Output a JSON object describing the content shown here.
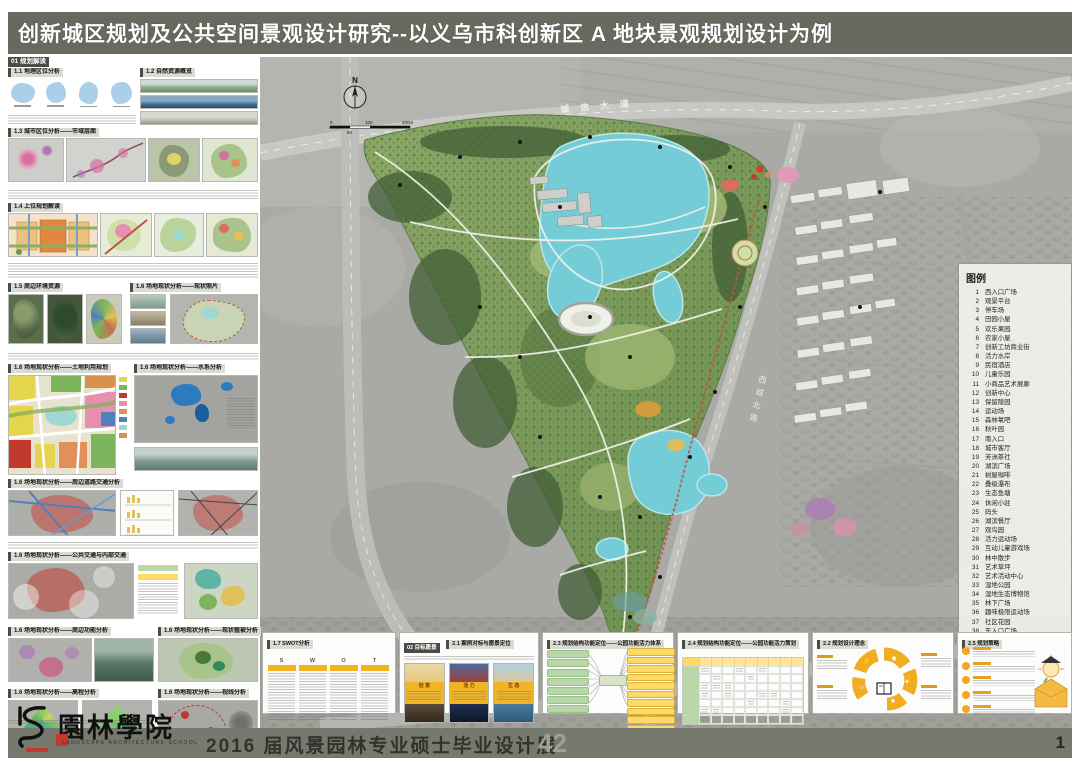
{
  "title": "创新城区规划及公共空间景观设计研究--以义乌市科创新区 A 地块景观规划设计为例",
  "page_no": "1",
  "footer": {
    "logo_cn": "園林學院",
    "logo_en": "LANDSCAPE ARCHITECTURE SCHOOL",
    "exhibition": "2016 届风景园林专业硕士毕业设计展",
    "board_no": "42"
  },
  "map": {
    "road_top": "诚信大道",
    "road_right": "西城北路",
    "north": "N",
    "scale": {
      "t0": "0",
      "t1": "50",
      "t2": "100",
      "t3": "200m"
    }
  },
  "legend": {
    "title": "图例",
    "items": [
      {
        "n": "1",
        "t": "西入口广场"
      },
      {
        "n": "2",
        "t": "观景平台"
      },
      {
        "n": "3",
        "t": "停车场"
      },
      {
        "n": "4",
        "t": "田园小屋"
      },
      {
        "n": "5",
        "t": "欢乐果园"
      },
      {
        "n": "6",
        "t": "农家小屋"
      },
      {
        "n": "7",
        "t": "创新工坊商业街"
      },
      {
        "n": "8",
        "t": "活力水岸"
      },
      {
        "n": "9",
        "t": "民宿酒店"
      },
      {
        "n": "10",
        "t": "儿童乐园"
      },
      {
        "n": "11",
        "t": "小商品艺术展廊"
      },
      {
        "n": "12",
        "t": "创新中心"
      },
      {
        "n": "13",
        "t": "保留陵园"
      },
      {
        "n": "14",
        "t": "运动场"
      },
      {
        "n": "15",
        "t": "森林氧吧"
      },
      {
        "n": "16",
        "t": "秋叶园"
      },
      {
        "n": "17",
        "t": "南入口"
      },
      {
        "n": "18",
        "t": "城市客厅"
      },
      {
        "n": "19",
        "t": "芳洲茶社"
      },
      {
        "n": "20",
        "t": "湖滨广场"
      },
      {
        "n": "21",
        "t": "树屋咖啡"
      },
      {
        "n": "22",
        "t": "叠级瀑布"
      },
      {
        "n": "23",
        "t": "生态鱼塘"
      },
      {
        "n": "24",
        "t": "休闲小驻"
      },
      {
        "n": "25",
        "t": "码头"
      },
      {
        "n": "26",
        "t": "湖滨餐厅"
      },
      {
        "n": "27",
        "t": "观鸟园"
      },
      {
        "n": "28",
        "t": "活力运动场"
      },
      {
        "n": "29",
        "t": "互动儿童游戏场"
      },
      {
        "n": "30",
        "t": "林中散步"
      },
      {
        "n": "31",
        "t": "艺术草坪"
      },
      {
        "n": "32",
        "t": "艺术活动中心"
      },
      {
        "n": "33",
        "t": "湿地公园"
      },
      {
        "n": "34",
        "t": "湿地生态博物馆"
      },
      {
        "n": "35",
        "t": "林下广场"
      },
      {
        "n": "36",
        "t": "趣味极限运动场"
      },
      {
        "n": "37",
        "t": "社区花园"
      },
      {
        "n": "38",
        "t": "东入口广场"
      },
      {
        "n": "39",
        "t": "创新街区"
      }
    ]
  },
  "left": {
    "s01": "01 规划解读",
    "h11": "1.1 地理区位分析",
    "h12": "1.2 自然资源概览",
    "h13": "1.3 城市区位分析——市域层面",
    "h14": "1.4 上位规划解读",
    "h15": "1.5 周边环境资源",
    "h16a": "1.6 场地现状分析——现状照片",
    "h16b": "1.6 场地现状分析——土地利用规划",
    "h16c": "1.6 场地现状分析——水系分析",
    "h16d": "1.6 场地现状分析——周边道路交通分析",
    "h16e": "1.6 场地现状分析——公共交通与内部交通",
    "h16f": "1.6 场地现状分析——周边功能分析",
    "h16f2": "1.6 场地现状分析——现状植被分析",
    "h16g": "1.6 场地现状分析——高程分析",
    "h16h": "1.6 场地现状分析——视线分析"
  },
  "bottom": {
    "swot": {
      "title": "1.7 SWOT分析",
      "letters": [
        "S",
        "W",
        "O",
        "T"
      ]
    },
    "vision": {
      "chip": "02 目标愿景",
      "title": "2.1 案例对标与愿景定位",
      "cards": [
        "创 意",
        "活 力",
        "生 态"
      ]
    },
    "p23": {
      "title": "2.3 规划结构功能定位——公园功能活力体系"
    },
    "p24": {
      "title": "2.4 规划结构功能定位——公园功能活力策划"
    },
    "p22": {
      "title": "2.2 规划设计理念"
    },
    "p25": {
      "title": "2.5 规划策略"
    }
  }
}
